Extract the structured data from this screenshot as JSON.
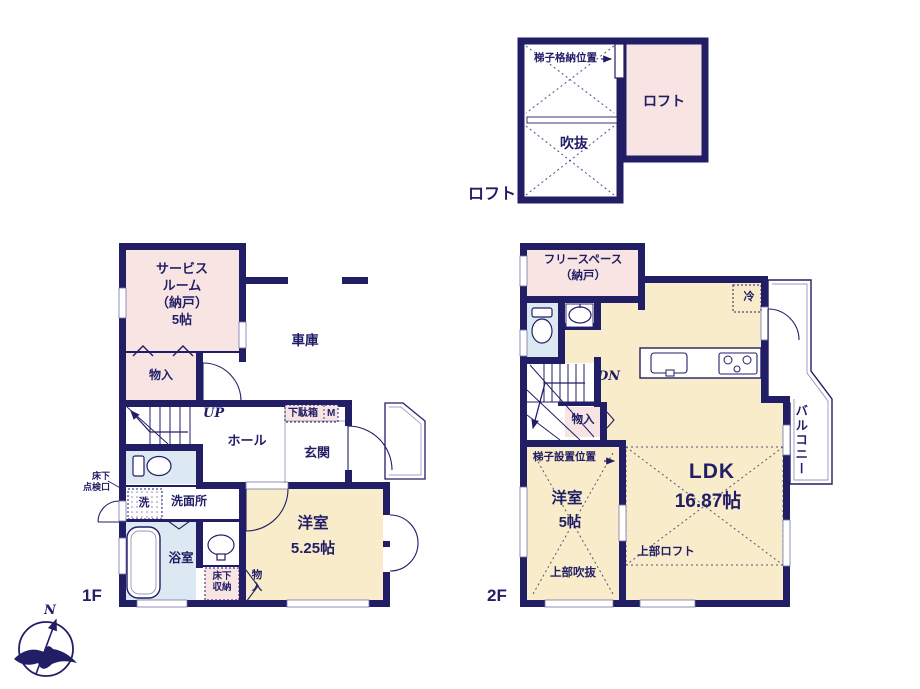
{
  "colors": {
    "wall_navy": "#221e66",
    "text_navy": "#221e66",
    "room_pink": "#f8e5e3",
    "room_tan": "#f8ecca",
    "room_blue": "#dde9f2",
    "window_white": "#ffffff"
  },
  "loft_plan": {
    "floor_label": "ロフト",
    "ladder_storage": "梯子格納位置",
    "void": "吹抜",
    "loft_room": "ロフト"
  },
  "floor_1": {
    "floor_label": "1F",
    "service_room": "サービス\nルーム\n（納戸）\n5帖",
    "closet_upper": "物入",
    "garage": "車庫",
    "stairs_up": "UP",
    "hall": "ホール",
    "shoe_cabinet": "下駄箱",
    "shoe_cabinet_m": "M",
    "entrance": "玄関",
    "underfloor_hatch": "床下\n点検口",
    "washer": "洗",
    "washroom": "洗面所",
    "bathroom": "浴室",
    "underfloor_storage": "床下\n収納",
    "closet_lower": "物\n入",
    "western_room": "洋室",
    "western_room_size": "5.25帖"
  },
  "floor_2": {
    "floor_label": "2F",
    "free_space": "フリースペース\n（納戸）",
    "refrigerator": "冷",
    "stairs_down": "DN",
    "closet": "物入",
    "ladder_position": "梯子設置位置",
    "western_room": "洋室",
    "western_room_size": "5帖",
    "open_ceiling_above": "上部吹抜",
    "ldk": "LDK",
    "ldk_size": "16.87帖",
    "loft_above": "上部ロフト",
    "balcony": "バルコニー"
  },
  "compass": {
    "north": "N"
  }
}
